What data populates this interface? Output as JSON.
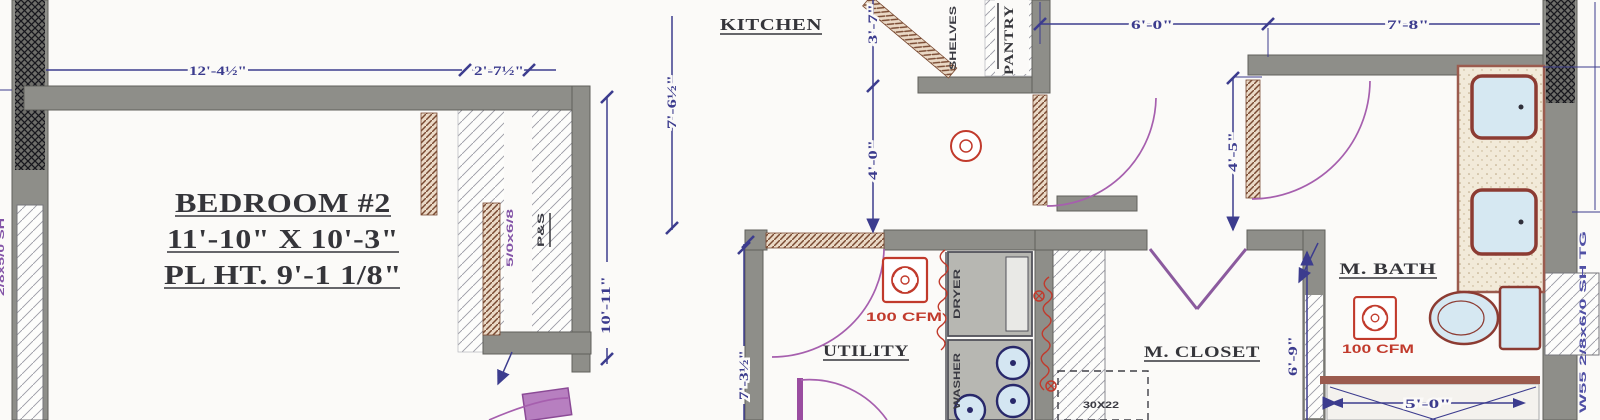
{
  "plan": {
    "rooms": {
      "bedroom2": {
        "name": "BEDROOM #2",
        "size": "11'-10\" X 10'-3\"",
        "plate_height": "PL HT. 9'-1 1/8\""
      },
      "kitchen": {
        "name": "KITCHEN"
      },
      "pantry": {
        "name": "PANTRY"
      },
      "utility": {
        "name": "UTILITY"
      },
      "master_closet": {
        "name": "M. CLOSET"
      },
      "master_bath": {
        "name": "M. BATH"
      }
    },
    "dimensions": {
      "bedroom_width": "12'-4½\"",
      "closet_offset": "2'-7½\"",
      "kitchen_depth": "7'-6½\"",
      "kitchen_seg_upper": "3'-7\"",
      "kitchen_seg_lower": "4'-0\"",
      "hall_width": "6'-0\"",
      "bath_width": "7'-8\"",
      "hall_depth": "4'-5\"",
      "bedroom_depth": "10'-11\"",
      "utility_depth": "7'-3½\"",
      "closet_depth": "6'-9\"",
      "shower_width": "5'-0\""
    },
    "annotations": {
      "fan_rating": "100 CFM",
      "pole_and_shelf": "P&S",
      "shelves": "SHELVES",
      "closet_door_tag": "5/0x6/8",
      "attic_access": "30X22",
      "window_tag_right": "W55 2/8x6/0 SH TG",
      "window_tag_left": "2/8x5/0 SH",
      "dryer": "DRYER",
      "washer": "WASHER"
    },
    "colors": {
      "wall": "#8e8e89",
      "dimension": "#3c3c8e",
      "door": "#9a4da0",
      "annotation_red": "#c13a2c",
      "fixture_fill": "#d6e8f2",
      "label": "#35353a"
    }
  }
}
